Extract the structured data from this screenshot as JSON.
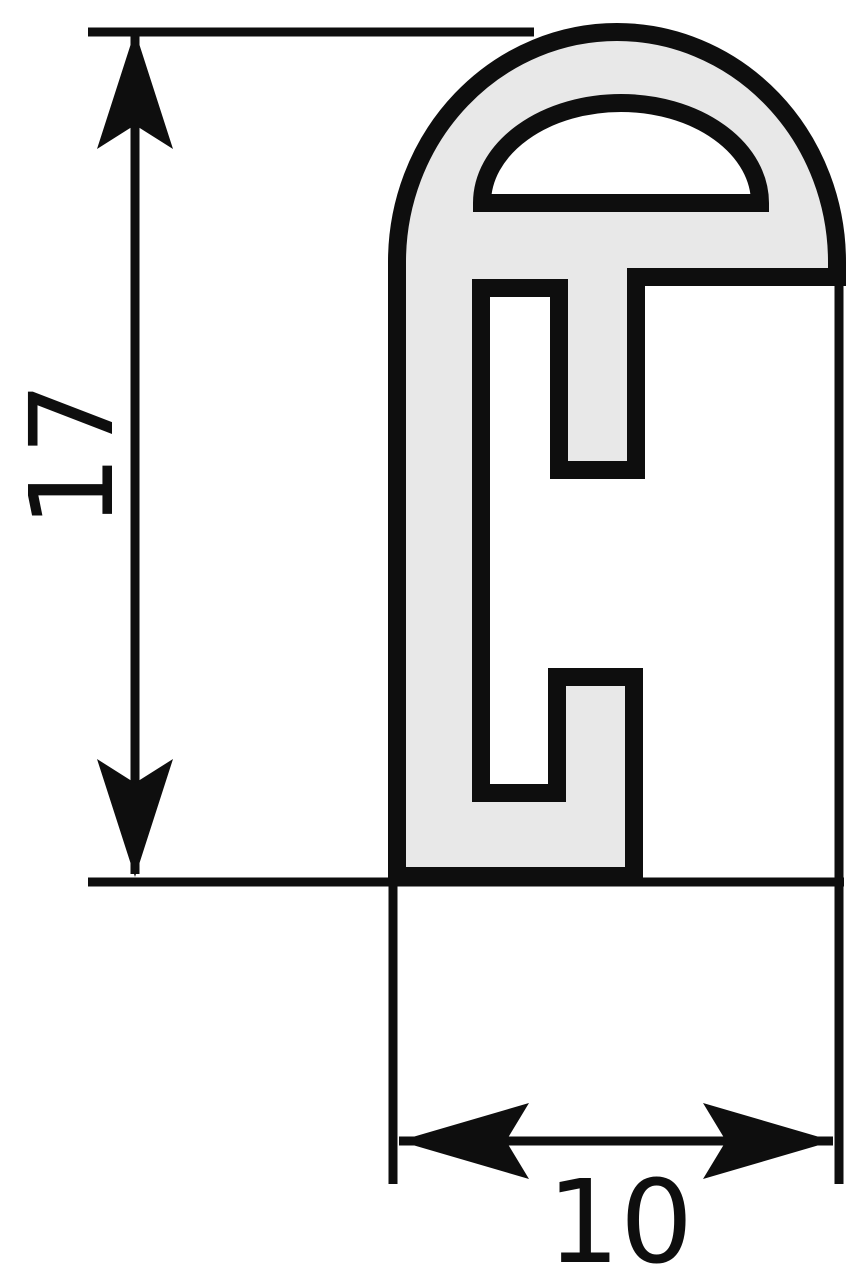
{
  "drawing": {
    "title": "profile-cross-section"
  },
  "dimensions": {
    "height": "17",
    "width": "10"
  },
  "colors": {
    "line": "#0e0e0e",
    "material": "#e8e8e8",
    "hollow": "#ffffff",
    "background": "#ffffff"
  }
}
